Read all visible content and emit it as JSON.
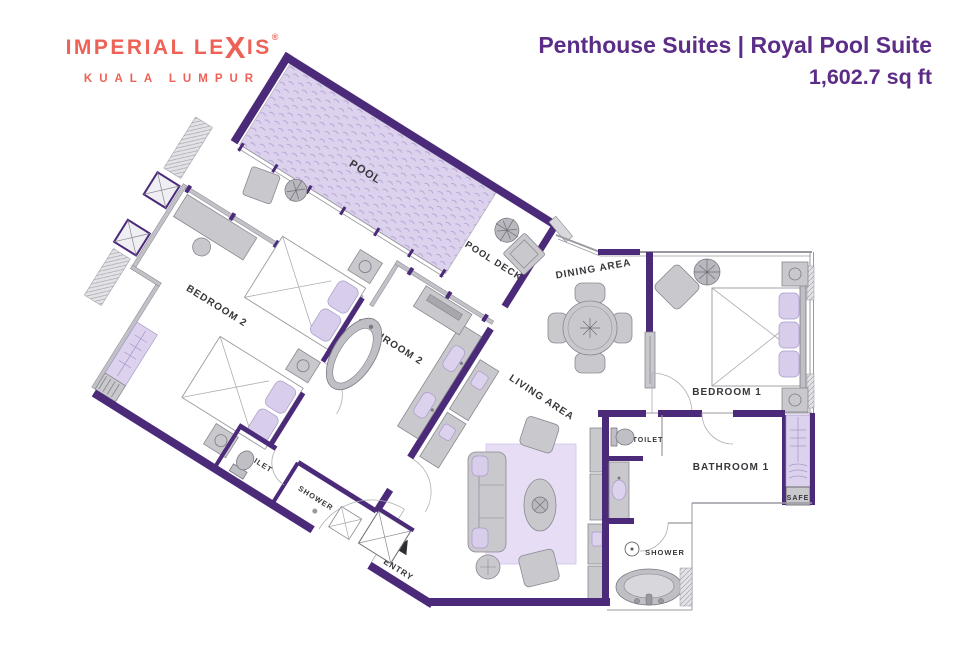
{
  "header": {
    "logo": {
      "line1_pre": "IMPERIAL LE",
      "line1_x": "X",
      "line1_post": "IS",
      "registered": "®",
      "line2": "KUALA LUMPUR"
    },
    "title_line1": "Penthouse Suites | Royal Pool Suite",
    "title_line2": "1,602.7 sq ft"
  },
  "floorplan": {
    "labels": {
      "pool": "POOL",
      "pool_deck": "POOL DECK",
      "dining": "DINING AREA",
      "living": "LIVING AREA",
      "bedroom1": "BEDROOM 1",
      "bedroom2": "BEDROOM 2",
      "bathroom1": "BATHROOM 1",
      "bathroom2": "BATHROOM 2",
      "toilet1": "TOILET",
      "toilet2": "TOILET",
      "shower1": "SHOWER",
      "shower2": "SHOWER",
      "safe": "SAFE",
      "entry": "ENTRY"
    },
    "colors": {
      "wall": "#4b2a7a",
      "pool_fill": "#ddd2ee",
      "rug_fill": "#e7def5",
      "furniture": "#c9c8cd",
      "title_purple": "#5b2d87",
      "logo_coral": "#ee6156",
      "label_text": "#37363a"
    },
    "left_wing_rotation_deg": 32
  }
}
